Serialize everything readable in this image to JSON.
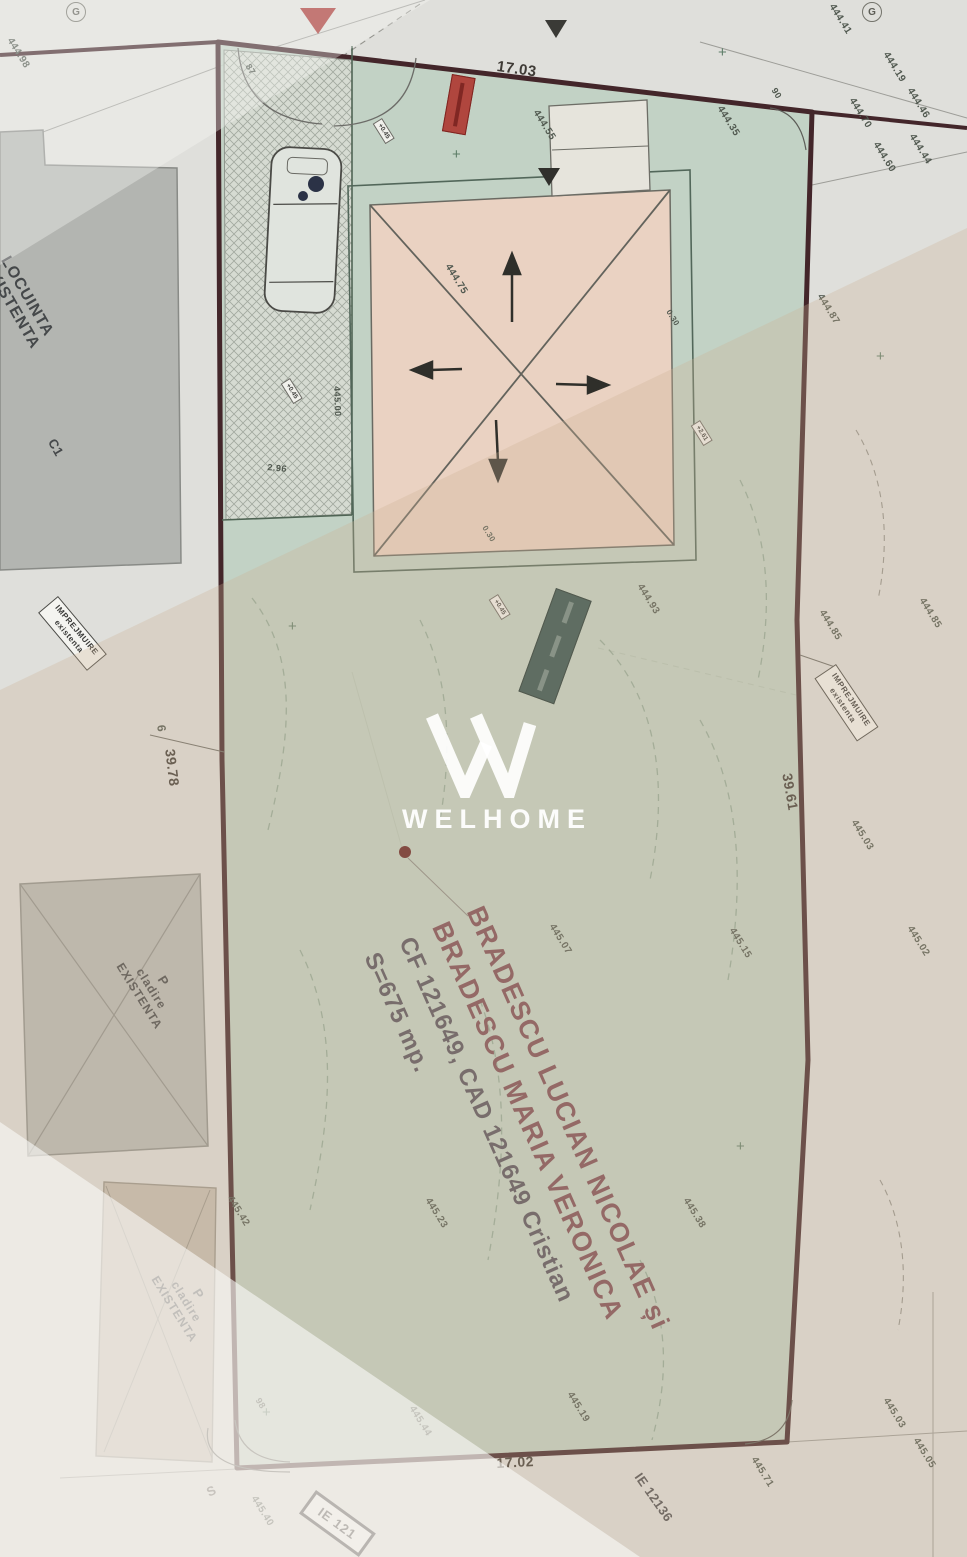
{
  "watermark": {
    "brand": "WELHOME"
  },
  "owner": {
    "line1": "BRADESCU LUCIAN NICOLAE și",
    "line2": "BRADESCU MARIA VERONICA",
    "line3": "CF 121649, CAD 121649 Cristian",
    "line4": "S=675 mp."
  },
  "dimensions": {
    "top": "17.03",
    "bottom": "17.02",
    "left": "39.78",
    "right": "39.61"
  },
  "buildings": {
    "house": {
      "line1": "LOCUINTA",
      "line2": "EXISTENTA",
      "code": "C1"
    },
    "annex1": {
      "line1": "P",
      "line2": "cladire",
      "line3": "EXISTENTA"
    },
    "annex2": {
      "line1": "P",
      "line2": "cladire",
      "line3": "EXISTENTA"
    }
  },
  "fence_label": {
    "line1": "IMPREJMUIRE",
    "line2": "existenta"
  },
  "markers": {
    "s_letter": "S",
    "compass": "G",
    "angle_tl": "87",
    "angle_tr": "90",
    "angle_bl": "98",
    "point6": "6"
  },
  "ie_labels": {
    "right": "IE 12136",
    "bottom": "IE 121"
  },
  "spot_labels": [
    "+0.45",
    "+0.45",
    "+2.61",
    "+0.45"
  ],
  "dim_small": {
    "a": "0.30",
    "b": "0.30",
    "c": "2.96",
    "d": "445.00"
  },
  "elevations": [
    {
      "t": "444.98",
      "x": 14,
      "y": 36
    },
    {
      "t": "444.41",
      "x": 836,
      "y": 2
    },
    {
      "t": "444.19",
      "x": 890,
      "y": 50
    },
    {
      "t": "444.70",
      "x": 856,
      "y": 96
    },
    {
      "t": "444.46",
      "x": 914,
      "y": 86
    },
    {
      "t": "444.60",
      "x": 880,
      "y": 140
    },
    {
      "t": "444.44",
      "x": 916,
      "y": 132
    },
    {
      "t": "444.35",
      "x": 724,
      "y": 104
    },
    {
      "t": "444.55",
      "x": 540,
      "y": 108
    },
    {
      "t": "444.75",
      "x": 452,
      "y": 262
    },
    {
      "t": "444.87",
      "x": 824,
      "y": 292
    },
    {
      "t": "444.93",
      "x": 644,
      "y": 582
    },
    {
      "t": "444.85",
      "x": 826,
      "y": 608
    },
    {
      "t": "444.85",
      "x": 926,
      "y": 596
    },
    {
      "t": "445.03",
      "x": 858,
      "y": 818
    },
    {
      "t": "445.02",
      "x": 914,
      "y": 924
    },
    {
      "t": "445.07",
      "x": 556,
      "y": 922
    },
    {
      "t": "445.15",
      "x": 736,
      "y": 926
    },
    {
      "t": "445.23",
      "x": 432,
      "y": 1196
    },
    {
      "t": "445.38",
      "x": 690,
      "y": 1196
    },
    {
      "t": "445.42",
      "x": 234,
      "y": 1194
    },
    {
      "t": "445.44",
      "x": 416,
      "y": 1404
    },
    {
      "t": "445.19",
      "x": 574,
      "y": 1390
    },
    {
      "t": "445.40",
      "x": 258,
      "y": 1494
    },
    {
      "t": "445.71",
      "x": 758,
      "y": 1455
    },
    {
      "t": "445.03",
      "x": 890,
      "y": 1396
    },
    {
      "t": "445.05",
      "x": 920,
      "y": 1436
    }
  ],
  "crosses": [
    {
      "x": 288,
      "y": 618
    },
    {
      "x": 718,
      "y": 44
    },
    {
      "x": 736,
      "y": 1138
    },
    {
      "x": 876,
      "y": 348
    },
    {
      "x": 262,
      "y": 1404
    },
    {
      "x": 452,
      "y": 146
    }
  ]
}
